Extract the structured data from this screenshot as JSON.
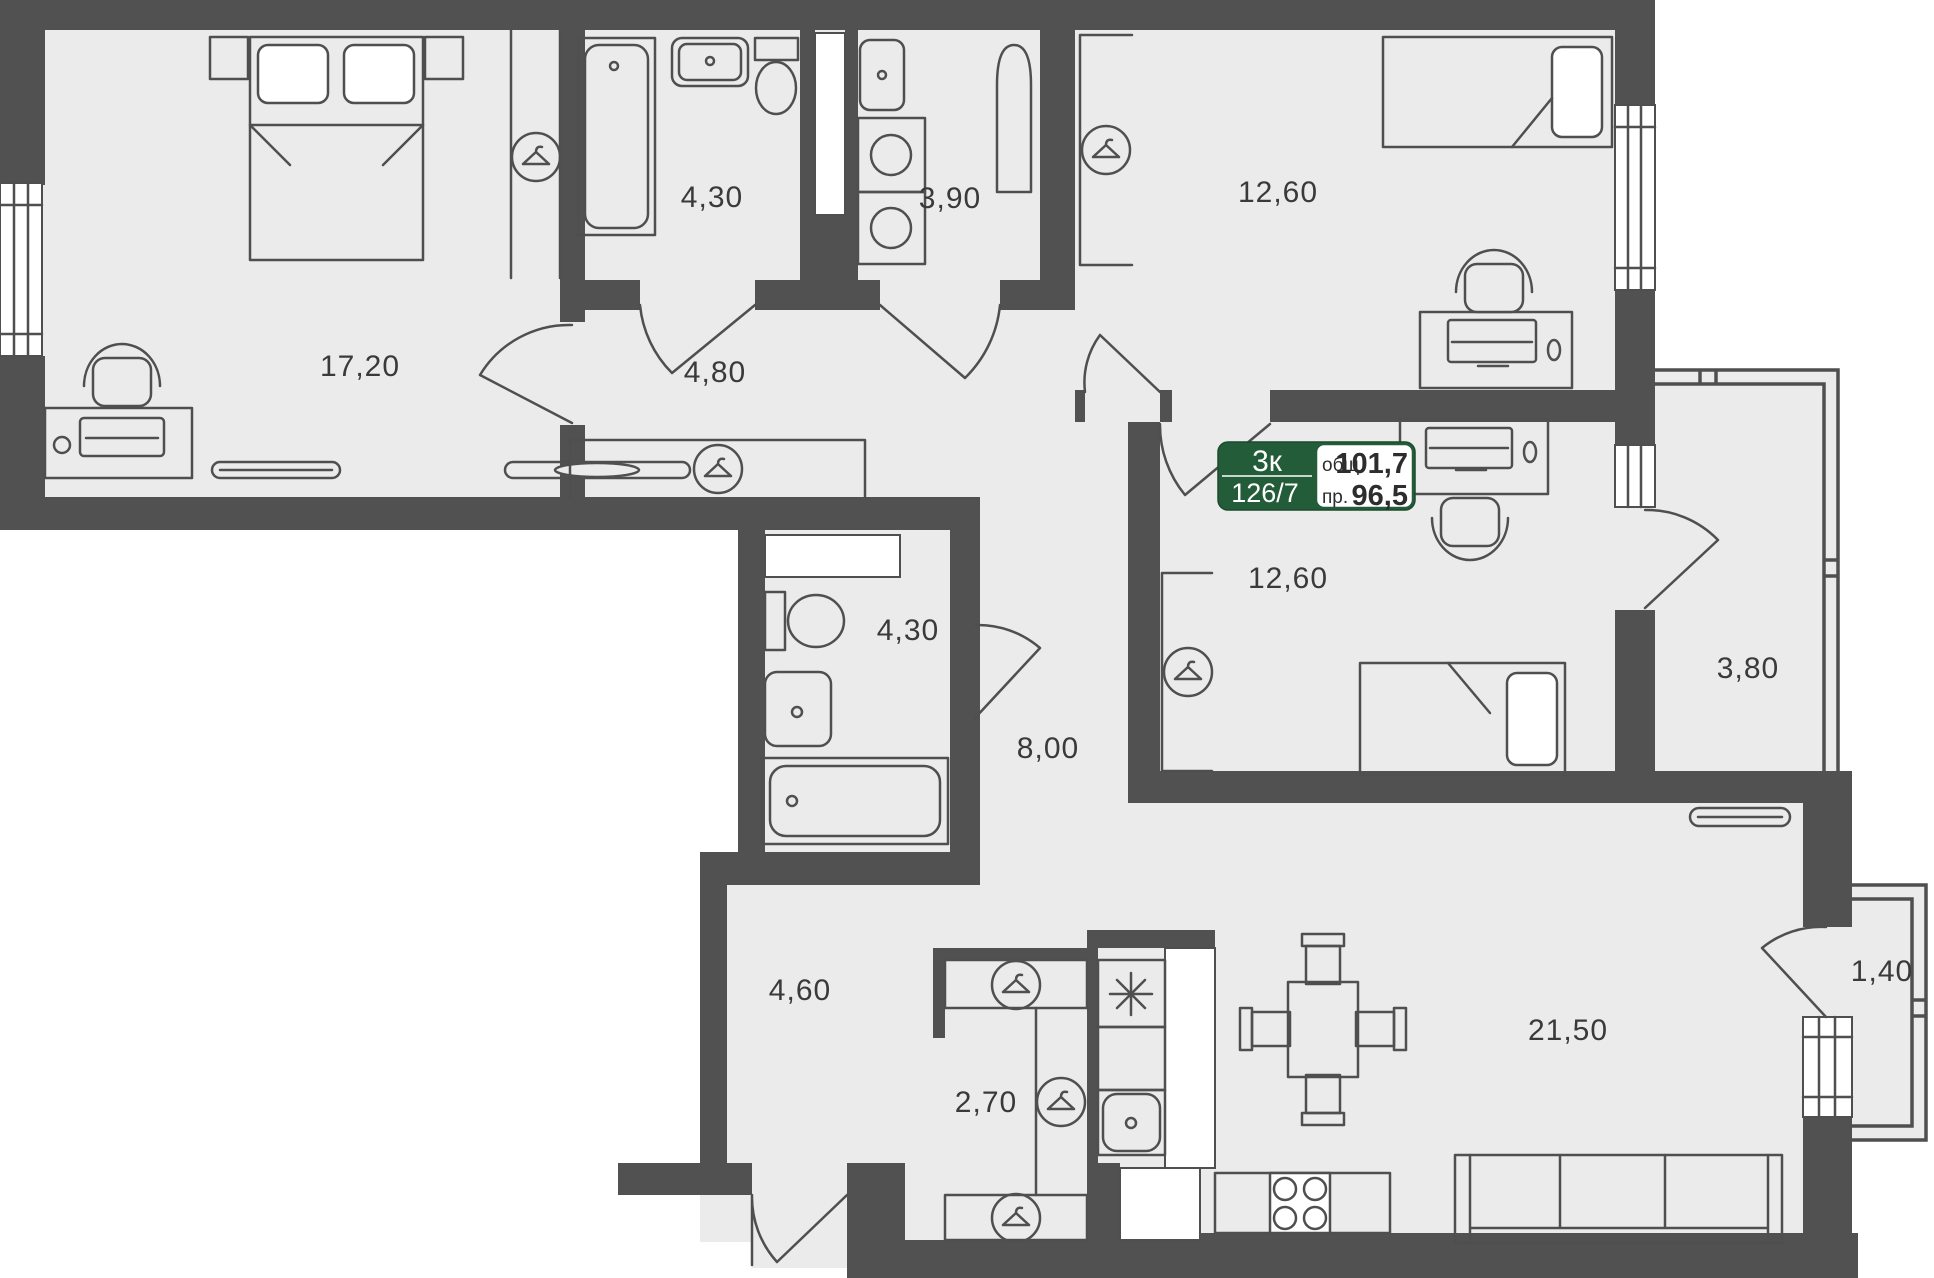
{
  "title": "Apartment floor plan",
  "badge": {
    "type": "3к",
    "number": "126/7",
    "total_label": "общ.",
    "total_area": "101,7",
    "living_label": "пр.",
    "living_area": "96,5"
  },
  "rooms": {
    "bedroom_main": "17,20",
    "shower_room": "4,30",
    "laundry": "3,90",
    "bedroom_top_right": "12,60",
    "hall_top": "4,80",
    "bedroom_middle": "12,60",
    "loggia": "3,80",
    "bathroom": "4,30",
    "corridor": "8,00",
    "entry_hall": "4,60",
    "wardrobe": "2,70",
    "kitchen_living": "21,50",
    "balcony": "1,40"
  },
  "icons": {
    "wardrobe": "hanger-in-circle-icon",
    "stove": "eight-point-asterisk-icon"
  },
  "colors": {
    "wall": "#515151",
    "floor": "#ebebeb",
    "line": "#4f4f4f",
    "accent_green": "#235c38",
    "text": "#3a3a3a"
  }
}
